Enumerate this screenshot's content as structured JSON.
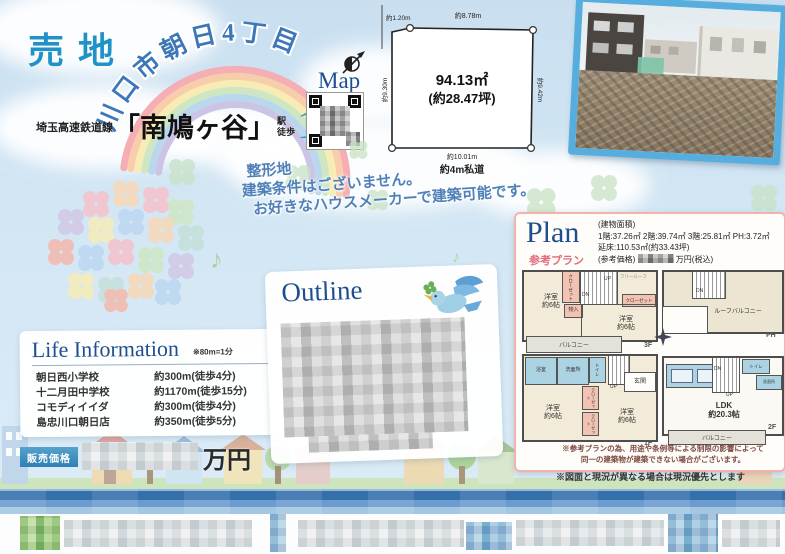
{
  "header": {
    "sale_label": "売地",
    "location": "川口市朝日4丁目",
    "rail_line": "埼玉高速鉄道線",
    "station": "「南鳩ヶ谷」",
    "station_word": "駅",
    "walk_word": "徒歩",
    "walk_minutes": "10",
    "minutes_label": "分",
    "map_label": "Map"
  },
  "land": {
    "area_sqm": "94.13㎡",
    "area_tsubo": "(約28.47坪)",
    "dim_top_left": "約1.20m",
    "dim_top": "約8.78m",
    "dim_left": "約9.30m",
    "dim_right": "約9.42m",
    "dim_bottom": "約10.01m",
    "road": "約4m私道"
  },
  "catch": {
    "line1": "整形地",
    "line2": "建築条件はございません。",
    "line3": "お好きなハウスメーカーで建築可能です。"
  },
  "life_information": {
    "title": "Life Information",
    "note": "※80m=1分",
    "items": [
      {
        "name": "朝日西小学校",
        "distance": "約300m(徒歩4分)"
      },
      {
        "name": "十二月田中学校",
        "distance": "約1170m(徒歩15分)"
      },
      {
        "name": "コモディイイダ",
        "distance": "約300m(徒歩4分)"
      },
      {
        "name": "島忠川口朝日店",
        "distance": "約350m(徒歩5分)"
      }
    ]
  },
  "outline": {
    "title": "Outline"
  },
  "plan": {
    "title": "Plan",
    "subtitle": "参考プラン",
    "area_label": "(建物面積)",
    "floors": "1階:37.26㎡ 2階:39.74㎡ 3階:25.81㎡ PH:3.72㎡",
    "total": "延床:110.53㎡(約33.43坪)",
    "price_label": "(参考価格)",
    "price_suffix": "万円(税込)",
    "labels": {
      "f1": "1F",
      "f2": "2F",
      "f3": "3F",
      "ph": "PH"
    },
    "rooms": {
      "western": "洋室",
      "six": "約6帖",
      "balcony": "バルコニー",
      "roof_balcony": "ルーフバルコニー",
      "ldk": "LDK",
      "ldk_size": "約20.3帖",
      "bath": "浴室",
      "washroom": "洗面所",
      "toilet": "トイレ",
      "entrance": "玄関",
      "closet": "クローゼット",
      "storage": "物入",
      "free_roof": "フリールーフ",
      "dn": "DN",
      "up": "UP"
    },
    "note1": "※参考プランの為、用途や条例等による制限の影響によって",
    "note2": "同一の建築物が建築できない場合がございます。"
  },
  "price": {
    "label": "販売価格",
    "unit": "万円"
  },
  "footnote": "※図面と現況が異なる場合は現況優先とします",
  "colors": {
    "accent_blue": "#2e93c6",
    "title_blue": "#1d4e8f",
    "plan_pink": "#e58a96",
    "banner_blue": "#3570ad"
  }
}
